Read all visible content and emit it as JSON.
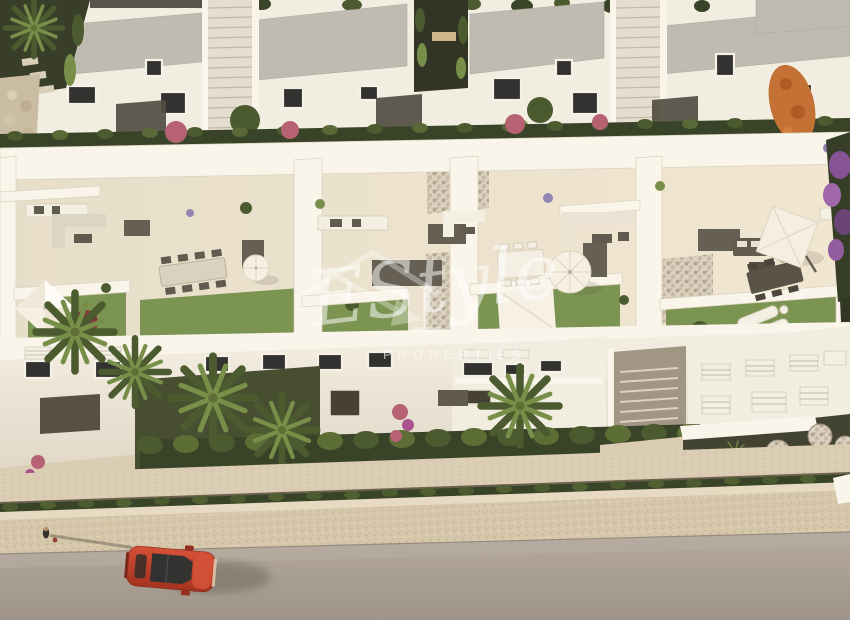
{
  "watermark": {
    "script": "EStyle",
    "caption": "PROPERTIES"
  },
  "colors": {
    "wall_white": "#f2efe8",
    "wall_bright": "#faf8f2",
    "wall_shade": "#e4dfd4",
    "roof_gray": "#bcbab4",
    "roof_gray_dark": "#a9a7a1",
    "terrace_floor": "#e9e2d2",
    "pebble": "#d8d1c2",
    "pebble_dot": "#a29a8a",
    "lawn": "#72904d",
    "hedge_dark": "#2a3820",
    "hedge_mid": "#3e5228",
    "leaf_bright": "#6d8a43",
    "soil_dark": "#35392c",
    "flower_pink": "#b25a72",
    "tree_orange": "#bf6a2f",
    "walkway_stone": "#d9cdb6",
    "sidewalk_stone": "#d3c6ad",
    "road_asphalt": "#a59c97",
    "car_red": "#c23a28",
    "glass_dark": "#23262b",
    "furniture_dark": "#55514a",
    "furniture_light": "#f4f1ea"
  }
}
